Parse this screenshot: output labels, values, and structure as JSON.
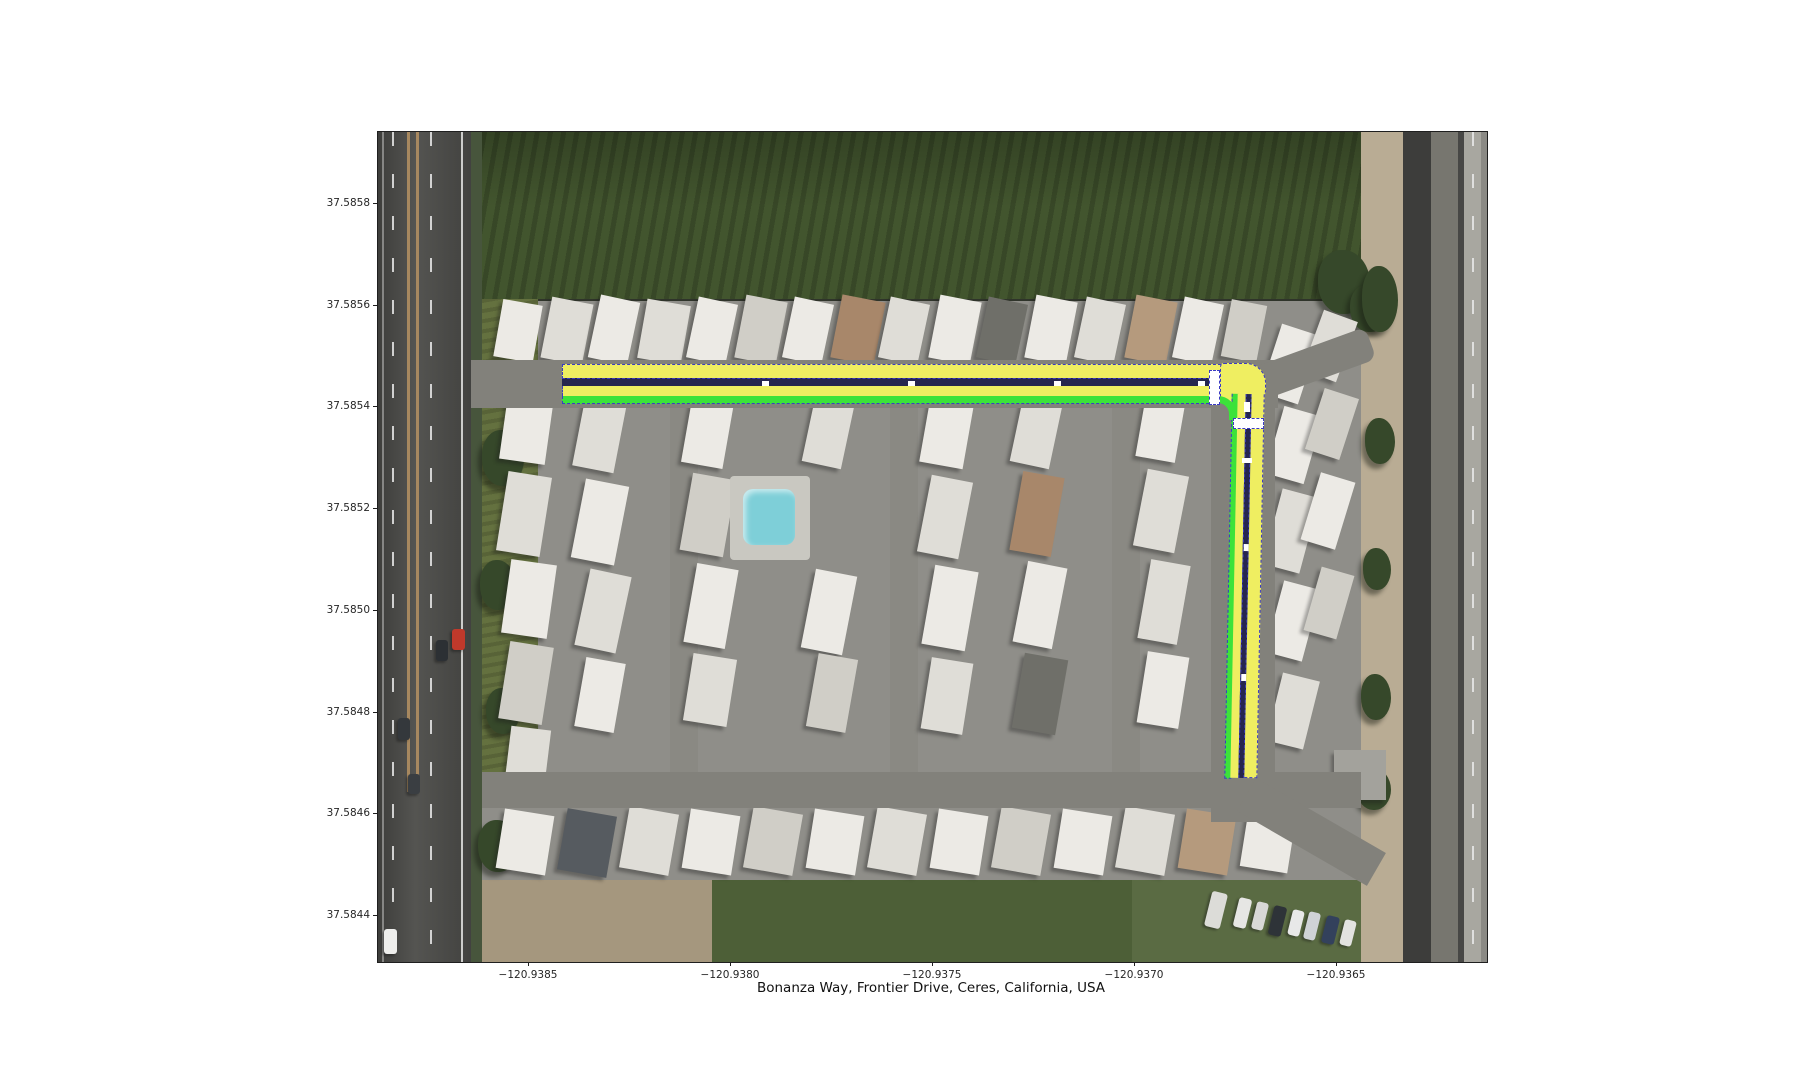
{
  "figure": {
    "xlabel": "Bonanza Way, Frontier Drive, Ceres, California, USA",
    "x_ticks": [
      "−120.9385",
      "−120.9380",
      "−120.9375",
      "−120.9370",
      "−120.9365"
    ],
    "y_ticks": [
      "37.5858",
      "37.5856",
      "37.5854",
      "37.5852",
      "37.5850",
      "37.5848",
      "37.5846",
      "37.5844"
    ]
  },
  "map": {
    "type": "satellite-aerial-with-route-overlay",
    "location": "Ceres, California, USA",
    "highlighted_roads": [
      "Bonanza Way",
      "Frontier Drive"
    ],
    "overlay_colors": {
      "lane_fill": "#efee61",
      "centerline": "#26264e",
      "edge_line": "#3ce23a",
      "boundary_dash": "#3b3bc4",
      "crossing_fill": "#ffffff"
    }
  }
}
